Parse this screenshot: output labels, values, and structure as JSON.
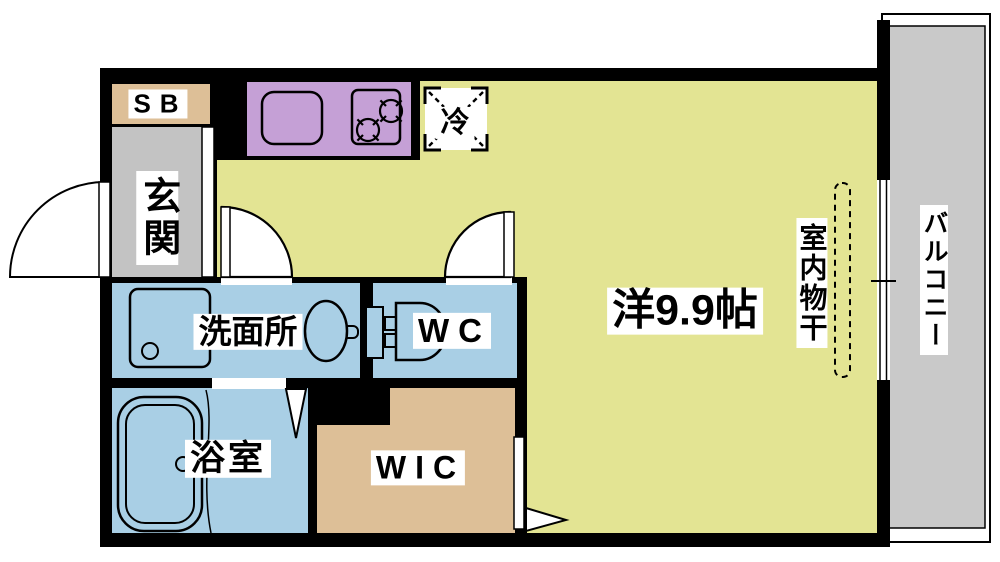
{
  "floorplan": {
    "labels": {
      "shoe_box": "SB",
      "entrance": "玄関",
      "refrigerator": "冷",
      "western_room": "洋9.9帖",
      "indoor_laundry": "室内物干",
      "balcony": "バルコニー",
      "washroom": "洗面所",
      "toilet": "WC",
      "bathroom": "浴室",
      "walk_in_closet": "WIC"
    },
    "colors": {
      "wall": "#000000",
      "western_room_fill": "#e3e493",
      "wet_area_fill": "#a9cfe5",
      "kitchen_counter_fill": "#c5a0d6",
      "storage_fill": "#ddbf97",
      "entrance_floor_fill": "#c3c3c3",
      "balcony_floor_fill": "#c9c9c9",
      "label_background": "#ffffff"
    }
  }
}
